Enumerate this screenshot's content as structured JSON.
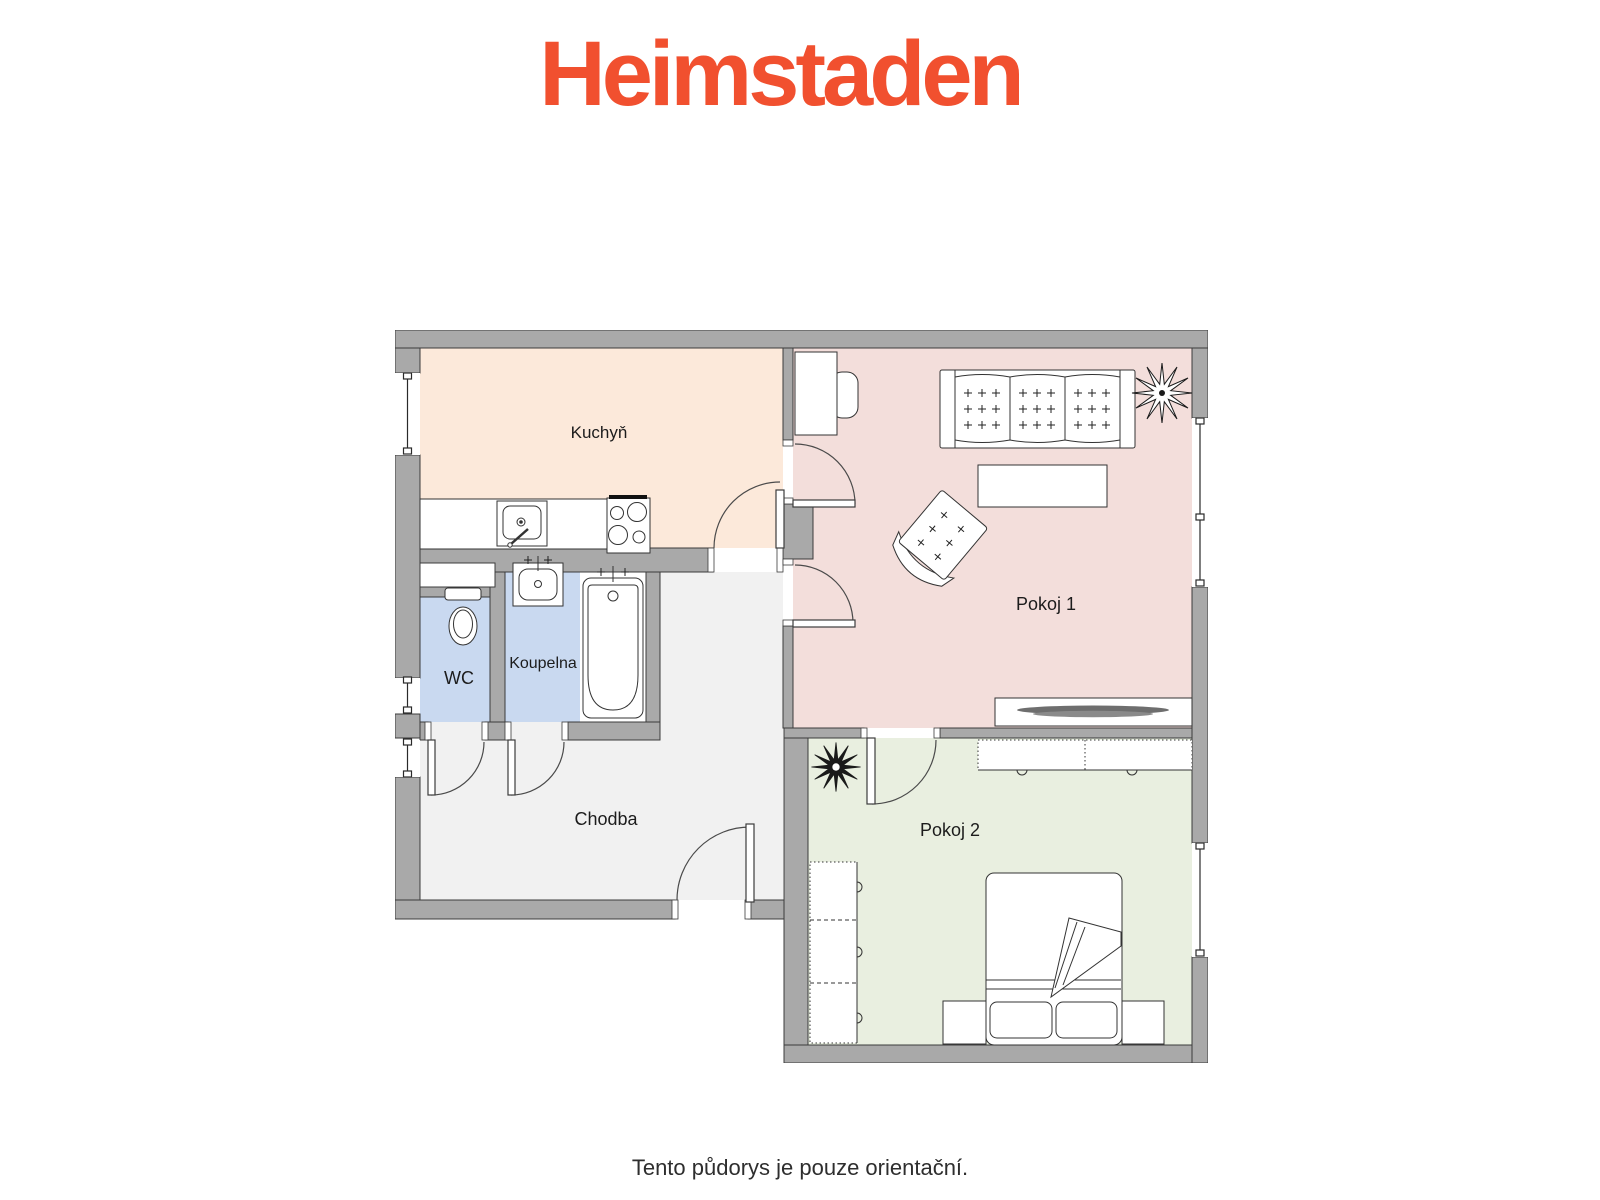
{
  "brand": {
    "logo_text": "Heimstaden",
    "logo_color": "#F1502F"
  },
  "floorplan": {
    "wall_color": "#A9A9A9",
    "outline_color": "#3C3C3C",
    "rooms": [
      {
        "id": "kuchyn",
        "label": "Kuchyň",
        "floor_color": "#FCE9DA"
      },
      {
        "id": "pokoj-1",
        "label": "Pokoj 1",
        "floor_color": "#F3DEDB"
      },
      {
        "id": "pokoj-2",
        "label": "Pokoj 2",
        "floor_color": "#E9EFE0"
      },
      {
        "id": "wc",
        "label": "WC",
        "floor_color": "#C9D9F0"
      },
      {
        "id": "koupelna",
        "label": "Koupelna",
        "floor_color": "#C9D9F0"
      },
      {
        "id": "chodba",
        "label": "Chodba",
        "floor_color": "#F1F1F1"
      }
    ],
    "furniture": [
      "kitchen-counter",
      "sink",
      "stove",
      "toilet",
      "washbasin",
      "bathtub",
      "desk",
      "desk-chair",
      "sofa",
      "coffee-table",
      "armchair",
      "plant",
      "tv-stand",
      "tv",
      "dresser",
      "wardrobe",
      "double-bed",
      "pillow",
      "nightstand"
    ]
  },
  "footer": {
    "disclaimer": "Tento půdorys je pouze orientační."
  }
}
